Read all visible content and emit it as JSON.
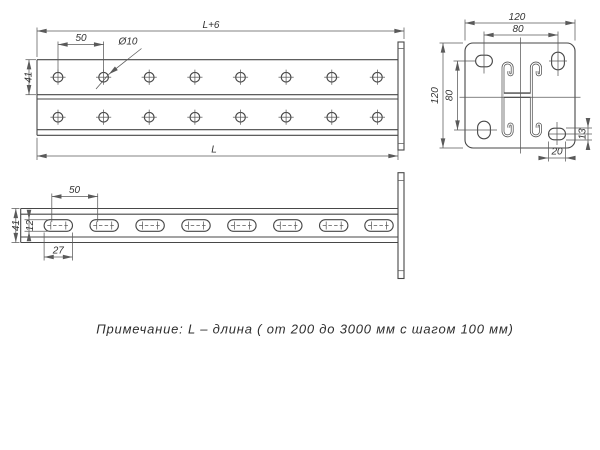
{
  "drawing": {
    "note": "Примечание: L – длина ( от 200 до 3000 мм с шагом 100 мм)",
    "plan_view": {
      "dim_overall_length": "L+6",
      "dim_hole_pitch": "50",
      "dim_hole_diameter": "Ø10",
      "dim_face_width": "41",
      "dim_body_length": "L"
    },
    "end_view": {
      "dim_plate_width": "120",
      "dim_hole_spacing_horizontal": "80",
      "dim_plate_height": "120",
      "dim_hole_spacing_vertical": "80",
      "dim_corner_slot_width": "13",
      "dim_corner_slot_length": "20"
    },
    "side_view": {
      "dim_slot_pitch": "50",
      "dim_height": "41",
      "dim_slot_width": "12",
      "dim_slot_length": "27"
    },
    "colors": {
      "object_line": "#474747",
      "dimension_line": "#5a5a5a",
      "text": "#333333",
      "background": "#ffffff"
    }
  }
}
